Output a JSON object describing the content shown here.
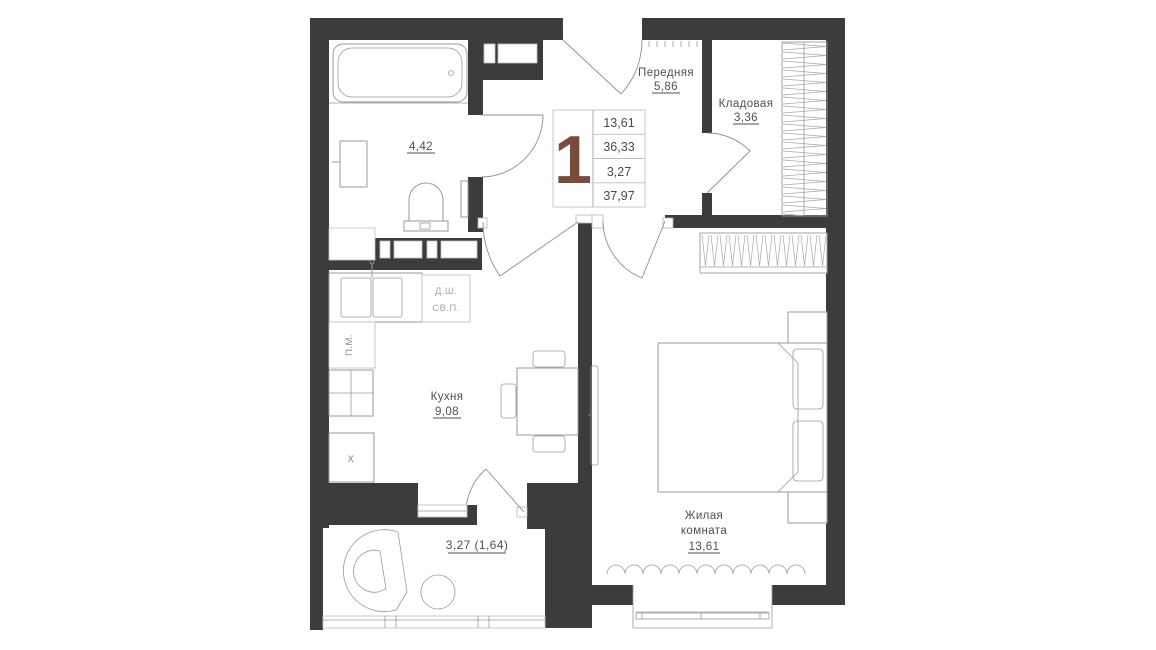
{
  "unit": {
    "rooms_count": "1",
    "stats": [
      "13,61",
      "36,33",
      "3,27",
      "37,97"
    ]
  },
  "rooms": {
    "hallway": {
      "name": "Передняя",
      "area": "5,86"
    },
    "storage": {
      "name": "Кладовая",
      "area": "3,36"
    },
    "bathroom": {
      "area": "4,42"
    },
    "kitchen": {
      "name": "Кухня",
      "area": "9,08"
    },
    "living": {
      "name_line1": "Жилая",
      "name_line2": "комната",
      "area": "13,61"
    },
    "balcony": {
      "area": "3,27 (1,64)"
    }
  },
  "marks": {
    "duct_top": "Д.Ш.",
    "duct_bottom": "СВ.П.",
    "washing_machine": "П.М.",
    "fridge": "х"
  },
  "colors": {
    "wall": "#3c3c3c",
    "furniture_line": "#9a9a9a",
    "text": "#4f4f4f",
    "muted_text": "#a8a8a8",
    "accent_number": "#7a4a3a"
  }
}
